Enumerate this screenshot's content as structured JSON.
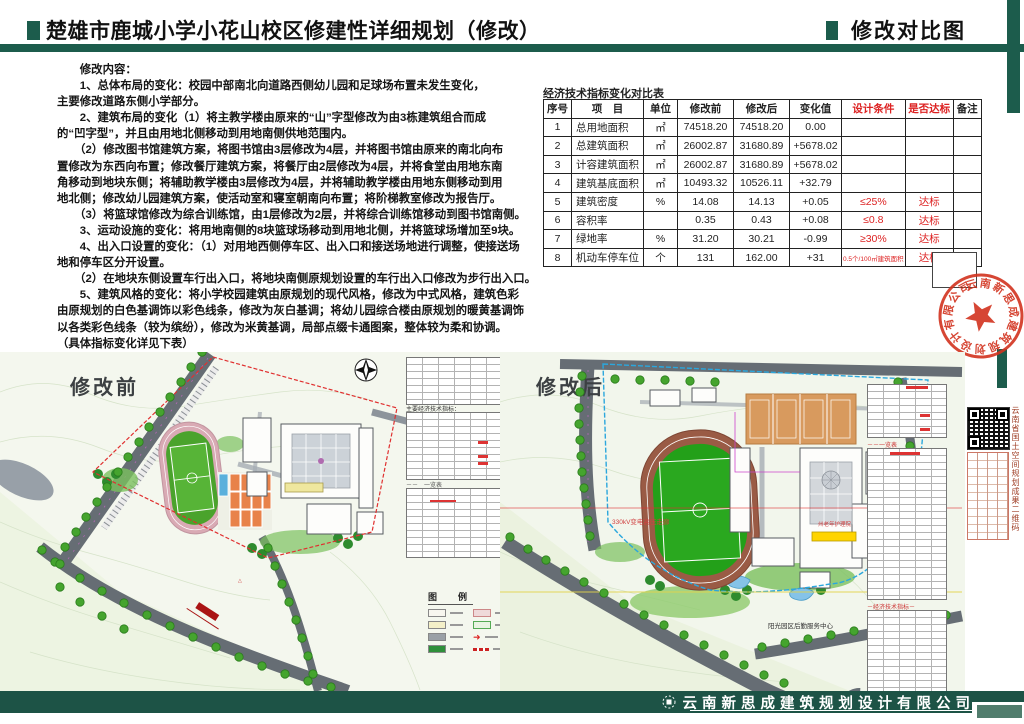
{
  "header": {
    "title_left": "楚雄市鹿城小学小花山校区修建性详细规划（修改）",
    "title_right": "修改对比图"
  },
  "content": {
    "lines": [
      "　　修改内容：",
      "　　1、总体布局的变化：校园中部南北向道路西侧幼儿园和足球场布置未发生变化，",
      "主要修改道路东侧小学部分。",
      "　　2、建筑布局的变化（1）将主教学楼由原来的“山”字型修改为由3栋建筑组合而成",
      "的“凹字型”，并且由用地北侧移动到用地南侧供地范围内。",
      "　　（2）修改图书馆建筑方案，将图书馆由3层修改为4层，并将图书馆由原来的南北向布",
      "置修改为东西向布置；修改餐厅建筑方案，将餐厅由2层修改为4层，并将食堂由用地东南",
      "角移动到地块东侧；将辅助教学楼由3层修改为4层，并将辅助教学楼由用地东侧移动到用",
      "地北侧；修改幼儿园建筑方案，使活动室和寝室朝南向布置；将阶梯教室修改为报告厅。",
      "　　（3）将篮球馆修改为综合训练馆，由1层修改为2层，并将综合训练馆移动到图书馆南侧。",
      "　　3、运动设施的变化：将用地南侧的8块篮球场移动到用地北侧，并将篮球场增加至9块。",
      "　　4、出入口设置的变化：（1）对用地西侧停车区、出入口和接送场地进行调整，使接送场",
      "地和停车区分开设置。",
      "　　（2）在地块东侧设置车行出入口，将地块南侧原规划设置的车行出入口修改为步行出入口。",
      "　　5、建筑风格的变化：将小学校园建筑由原规划的现代风格，修改为中式风格，建筑色彩",
      "由原规划的白色基调饰以彩色线条，修改为灰白基调；将幼儿园综合楼由原规划的暖黄基调饰",
      "以各类彩色线条（较为缤纷），修改为米黄基调，局部点缀卡通图案，整体较为柔和协调。",
      "（具体指标变化详见下表）"
    ]
  },
  "table": {
    "caption": "经济技术指标变化对比表",
    "columns": [
      "序号",
      "项　目",
      "单位",
      "修改前",
      "修改后",
      "变化值",
      "设计条件",
      "是否达标",
      "备注"
    ],
    "rows": [
      [
        "1",
        "总用地面积",
        "㎡",
        "74518.20",
        "74518.20",
        "0.00",
        "",
        "",
        ""
      ],
      [
        "2",
        "总建筑面积",
        "㎡",
        "26002.87",
        "31680.89",
        "+5678.02",
        "",
        "",
        ""
      ],
      [
        "3",
        "计容建筑面积",
        "㎡",
        "26002.87",
        "31680.89",
        "+5678.02",
        "",
        "",
        ""
      ],
      [
        "4",
        "建筑基底面积",
        "㎡",
        "10493.32",
        "10526.11",
        "+32.79",
        "",
        "",
        ""
      ],
      [
        "5",
        "建筑密度",
        "%",
        "14.08",
        "14.13",
        "+0.05",
        "≤25%",
        "达标",
        ""
      ],
      [
        "6",
        "容积率",
        "",
        "0.35",
        "0.43",
        "+0.08",
        "≤0.8",
        "达标",
        ""
      ],
      [
        "7",
        "绿地率",
        "%",
        "31.20",
        "30.21",
        "-0.99",
        "≥30%",
        "达标",
        ""
      ],
      [
        "8",
        "机动车停车位",
        "个",
        "131",
        "162.00",
        "+31",
        "0.5个/100㎡建筑面积",
        "达标",
        ""
      ]
    ]
  },
  "plans": {
    "before": {
      "label": "修改前",
      "minitable_caption": "主要经济技术指标：",
      "legend_title": "图　例"
    },
    "after": {
      "label": "修改后",
      "qr_caption": "云南省国土空间规划成果二维码",
      "note_corridor": "330kV变电高压走廊",
      "note_nursing": "州老年护理院",
      "note_service": "阳光园区后勤服务中心"
    }
  },
  "stamp": {
    "text": "云南新思成建筑规划设计有限公司"
  },
  "footer": {
    "company": "云南新思成建筑规划设计有限公司"
  },
  "colors": {
    "brand_green": "#1c5c4c",
    "footer_green": "#1d5346",
    "stamp_red": "#d2331f",
    "table_red": "#dd2222",
    "track_before": "#d9aab4",
    "track_after": "#9a5b45",
    "field_green": "#3fa32c",
    "court_orange": "#e8824a",
    "boundary_before": "#e03030",
    "boundary_after": "#2ba7dd"
  }
}
